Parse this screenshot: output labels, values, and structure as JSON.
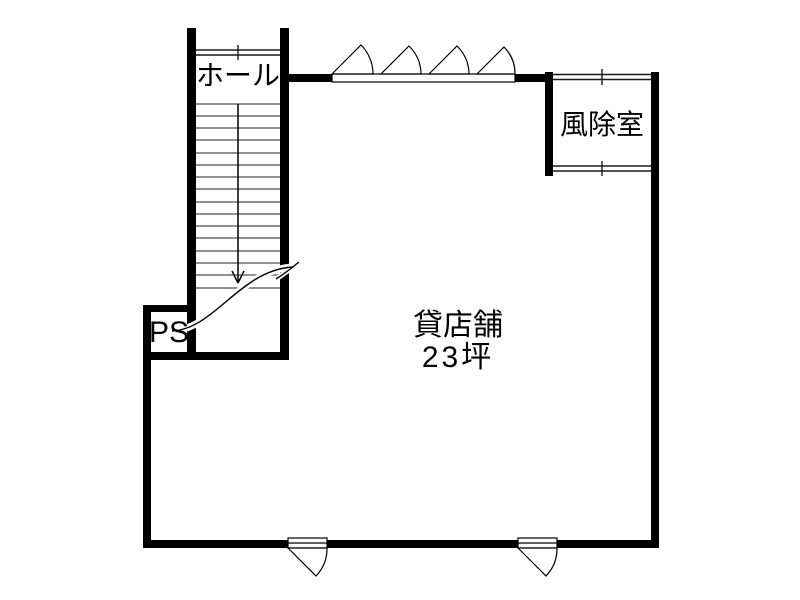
{
  "drawing": {
    "type": "floor-plan",
    "labels": {
      "hall": "ホール",
      "vestibule": "風除室",
      "shop_name": "貸店舗",
      "shop_area": "23坪",
      "pipe_space": "PS"
    },
    "stairs": {
      "tread_count": 16,
      "direction": "down"
    },
    "colors": {
      "wall": "#000000",
      "line": "#1a1a1a",
      "tread": "#4d4d4d",
      "background": "#ffffff"
    }
  }
}
